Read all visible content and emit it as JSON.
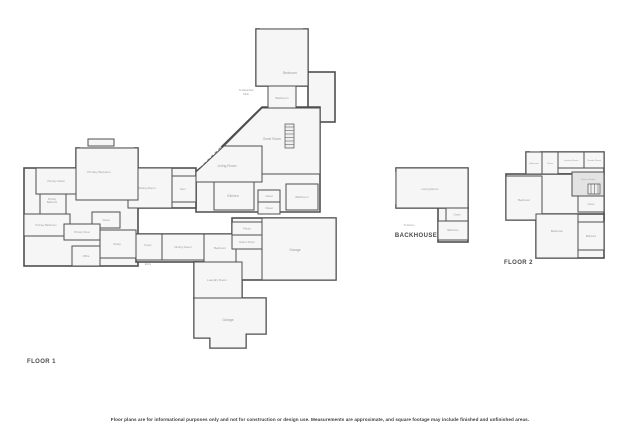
{
  "canvas": {
    "width": 640,
    "height": 426,
    "background": "#ffffff"
  },
  "colors": {
    "wall": "#4f4f4f",
    "room_fill": "#f6f6f6",
    "open_below": "#e3e3e3",
    "stairs_fill": "#efefef",
    "label": "#9a9a9a",
    "window": "#8c8c8c",
    "title": "#4a4a4a",
    "disclaimer": "#3c3c3c"
  },
  "disclaimer": "Floor plans are for informational purposes only and not for construction or design use. Measurements are approximate, and square footage may include finished and unfinished areas.",
  "plans": [
    {
      "id": "floor-1",
      "title": "FLOOR 1",
      "base": [
        {
          "x": 256,
          "y": 29,
          "w": 52,
          "h": 57
        },
        {
          "x": 308,
          "y": 72,
          "w": 27,
          "h": 50
        },
        {
          "points": "196,172 262,107 320,107 320,212 196,212"
        },
        {
          "x": 128,
          "y": 168,
          "w": 68,
          "h": 40
        },
        {
          "x": 76,
          "y": 148,
          "w": 62,
          "h": 52
        },
        {
          "x": 24,
          "y": 168,
          "w": 114,
          "h": 98
        },
        {
          "x": 136,
          "y": 234,
          "w": 100,
          "h": 28
        },
        {
          "x": 194,
          "y": 262,
          "w": 48,
          "h": 36
        },
        {
          "x": 232,
          "y": 218,
          "w": 104,
          "h": 62
        },
        {
          "points": "194,298 266,298 266,334 246,334 246,348 210,348 210,338 194,338"
        }
      ],
      "rooms": [
        {
          "name": "bedroom",
          "label": "Bedroom",
          "x": 256,
          "y": 29,
          "w": 52,
          "h": 57,
          "lx": 290,
          "ly": 74
        },
        {
          "name": "bathroom",
          "label": "Bathroom",
          "x": 268,
          "y": 86,
          "w": 28,
          "h": 24,
          "fs": 3
        },
        {
          "name": "great-room",
          "label": "Great Room",
          "points": "224,146 262,108 320,108 320,174 262,174 262,146",
          "lx": 272,
          "ly": 140
        },
        {
          "name": "living-room",
          "label": "Living Room",
          "points": "196,172 224,146 262,146 262,182 196,182",
          "lx": 227,
          "ly": 167
        },
        {
          "name": "kitchen",
          "label": "Kitchen",
          "x": 214,
          "y": 182,
          "w": 40,
          "h": 28,
          "lx": 233,
          "ly": 197
        },
        {
          "name": "closet",
          "label": "Closet",
          "x": 258,
          "y": 190,
          "w": 22,
          "h": 12,
          "fs": 2.6
        },
        {
          "name": "closet",
          "label": "Closet",
          "x": 258,
          "y": 202,
          "w": 22,
          "h": 12,
          "fs": 2.6
        },
        {
          "name": "bathroom",
          "label": "Bathroom",
          "x": 286,
          "y": 184,
          "w": 32,
          "h": 26,
          "lx": 302,
          "ly": 198,
          "fs": 3
        },
        {
          "name": "stairs",
          "type": "stairs",
          "x": 285,
          "y": 124,
          "w": 9,
          "h": 24
        },
        {
          "name": "sitting-room",
          "label": "Sitting Room",
          "x": 128,
          "y": 168,
          "w": 44,
          "h": 40,
          "lx": 147,
          "ly": 189,
          "fs": 3
        },
        {
          "name": "den",
          "label": "Den",
          "x": 172,
          "y": 176,
          "w": 24,
          "h": 26,
          "lx": 183,
          "ly": 190,
          "fs": 3
        },
        {
          "name": "primary-bedroom",
          "label": "Primary Bedroom",
          "x": 76,
          "y": 148,
          "w": 62,
          "h": 52,
          "lx": 99,
          "ly": 173,
          "fs": 3
        },
        {
          "name": "porch-detail",
          "x": 88,
          "y": 139,
          "w": 26,
          "h": 7
        },
        {
          "name": "primary-closet",
          "label": "Primary Closet",
          "x": 36,
          "y": 168,
          "w": 40,
          "h": 26,
          "lx": 56,
          "ly": 182,
          "fs": 2.6
        },
        {
          "name": "primary-bathroom",
          "label": "Primary Bathroom",
          "x": 40,
          "y": 194,
          "w": 26,
          "h": 20,
          "lx": 52,
          "ly": 200,
          "fs": 2.4,
          "wrap": true
        },
        {
          "name": "primary-bathroom",
          "label": "Primary Bathroom",
          "x": 24,
          "y": 214,
          "w": 46,
          "h": 22,
          "lx": 46,
          "ly": 226,
          "fs": 2.6
        },
        {
          "name": "closet",
          "label": "Closet",
          "x": 92,
          "y": 212,
          "w": 28,
          "h": 16,
          "fs": 2.6
        },
        {
          "name": "primary-closet",
          "label": "Primary Closet",
          "x": 64,
          "y": 224,
          "w": 36,
          "h": 16,
          "fs": 2.4
        },
        {
          "name": "study",
          "label": "Study",
          "x": 100,
          "y": 230,
          "w": 36,
          "h": 28,
          "lx": 117,
          "ly": 245,
          "fs": 3
        },
        {
          "name": "office",
          "label": "Office",
          "x": 72,
          "y": 246,
          "w": 28,
          "h": 20,
          "lx": 86,
          "ly": 257,
          "fs": 2.6
        },
        {
          "name": "foyer",
          "label": "Foyer",
          "x": 136,
          "y": 234,
          "w": 26,
          "h": 26,
          "lx": 148,
          "ly": 246,
          "fs": 2.8
        },
        {
          "name": "dining-room",
          "label": "Dining Room",
          "x": 162,
          "y": 234,
          "w": 42,
          "h": 26,
          "lx": 183,
          "ly": 248,
          "fs": 3
        },
        {
          "name": "bedroom",
          "label": "Bedroom",
          "x": 204,
          "y": 234,
          "w": 32,
          "h": 28,
          "lx": 220,
          "ly": 249,
          "fs": 3
        },
        {
          "name": "pantry",
          "label": "Pantry",
          "x": 232,
          "y": 222,
          "w": 30,
          "h": 13,
          "fs": 2.6
        },
        {
          "name": "butlers-pantry",
          "label": "Butler's Pantry",
          "x": 232,
          "y": 235,
          "w": 30,
          "h": 14,
          "fs": 2.4
        },
        {
          "name": "garage",
          "label": "Garage",
          "x": 262,
          "y": 218,
          "w": 74,
          "h": 62,
          "lx": 295,
          "ly": 251
        },
        {
          "name": "laundry-room",
          "label": "Laundry Room",
          "x": 194,
          "y": 262,
          "w": 48,
          "h": 36,
          "lx": 217,
          "ly": 281,
          "fs": 3
        },
        {
          "name": "garage",
          "label": "Garage",
          "points": "194,298 266,298 266,334 246,334 246,348 210,348 210,338 194,338",
          "lx": 228,
          "ly": 321
        }
      ],
      "windows": [
        {
          "x1": 260,
          "y1": 29,
          "x2": 303,
          "y2": 29
        },
        {
          "x1": 80,
          "y1": 148,
          "x2": 134,
          "y2": 148
        },
        {
          "x1": 200,
          "y1": 168,
          "x2": 221,
          "y2": 147
        },
        {
          "x1": 128,
          "y1": 172,
          "x2": 128,
          "y2": 200
        }
      ],
      "notes": [
        {
          "text": "To Detached",
          "x": 246,
          "y": 91
        },
        {
          "text": "Patio",
          "x": 246,
          "y": 95
        },
        {
          "text": "Entry",
          "x": 148,
          "y": 265
        }
      ]
    },
    {
      "id": "backhouse",
      "title": "BACKHOUSE",
      "base": [
        {
          "x": 396,
          "y": 168,
          "w": 72,
          "h": 40
        },
        {
          "x": 438,
          "y": 208,
          "w": 30,
          "h": 34
        }
      ],
      "rooms": [
        {
          "name": "living-room",
          "label": "Living Room",
          "x": 396,
          "y": 168,
          "w": 72,
          "h": 40,
          "lx": 430,
          "ly": 190,
          "fs": 3
        },
        {
          "name": "closet",
          "label": "Closet",
          "x": 446,
          "y": 208,
          "w": 22,
          "h": 13,
          "fs": 2.4
        },
        {
          "name": "bathroom",
          "label": "Bathroom",
          "x": 438,
          "y": 221,
          "w": 30,
          "h": 19,
          "lx": 453,
          "ly": 231,
          "fs": 2.6
        }
      ],
      "windows": [
        {
          "x1": 396,
          "y1": 172,
          "x2": 396,
          "y2": 204
        }
      ],
      "notes": [
        {
          "text": "To Atrium",
          "x": 409,
          "y": 226
        }
      ]
    },
    {
      "id": "floor-2",
      "title": "FLOOR 2",
      "base": [
        {
          "x": 526,
          "y": 152,
          "w": 78,
          "h": 22
        },
        {
          "x": 506,
          "y": 174,
          "w": 98,
          "h": 46
        },
        {
          "x": 536,
          "y": 214,
          "w": 68,
          "h": 44
        }
      ],
      "rooms": [
        {
          "name": "bathroom",
          "label": "Bathroom",
          "x": 526,
          "y": 152,
          "w": 16,
          "h": 22,
          "lx": 534,
          "ly": 164,
          "fs": 2.2
        },
        {
          "name": "closet",
          "label": "Closet",
          "x": 542,
          "y": 152,
          "w": 16,
          "h": 22,
          "lx": 550,
          "ly": 164,
          "fs": 2.2
        },
        {
          "name": "laundry-room",
          "label": "Laundry Room",
          "x": 558,
          "y": 152,
          "w": 26,
          "h": 16,
          "lx": 571,
          "ly": 161,
          "fs": 2.2
        },
        {
          "name": "powder-room",
          "label": "Powder Room",
          "x": 584,
          "y": 152,
          "w": 20,
          "h": 16,
          "lx": 594,
          "ly": 161,
          "fs": 2.2
        },
        {
          "name": "open-to-below",
          "label": "Open to Below",
          "x": 572,
          "y": 172,
          "w": 32,
          "h": 24,
          "fill": "open_below",
          "lx": 588,
          "ly": 180,
          "fs": 2.2
        },
        {
          "name": "stairs",
          "type": "stairs",
          "x": 588,
          "y": 184,
          "w": 12,
          "h": 10
        },
        {
          "name": "bedroom",
          "label": "Bedroom",
          "x": 506,
          "y": 176,
          "w": 36,
          "h": 44,
          "lx": 524,
          "ly": 201,
          "fs": 3
        },
        {
          "name": "closet",
          "label": "Closet",
          "x": 578,
          "y": 196,
          "w": 26,
          "h": 16,
          "lx": 591,
          "ly": 205,
          "fs": 2.4
        },
        {
          "name": "bedroom",
          "label": "Bedroom",
          "x": 536,
          "y": 214,
          "w": 42,
          "h": 44,
          "lx": 557,
          "ly": 232,
          "fs": 3
        },
        {
          "name": "bathroom",
          "label": "Bathroom",
          "x": 578,
          "y": 222,
          "w": 26,
          "h": 28,
          "lx": 591,
          "ly": 237,
          "fs": 2.4
        }
      ],
      "windows": [
        {
          "x1": 530,
          "y1": 152,
          "x2": 540,
          "y2": 152
        }
      ],
      "notes": []
    }
  ]
}
